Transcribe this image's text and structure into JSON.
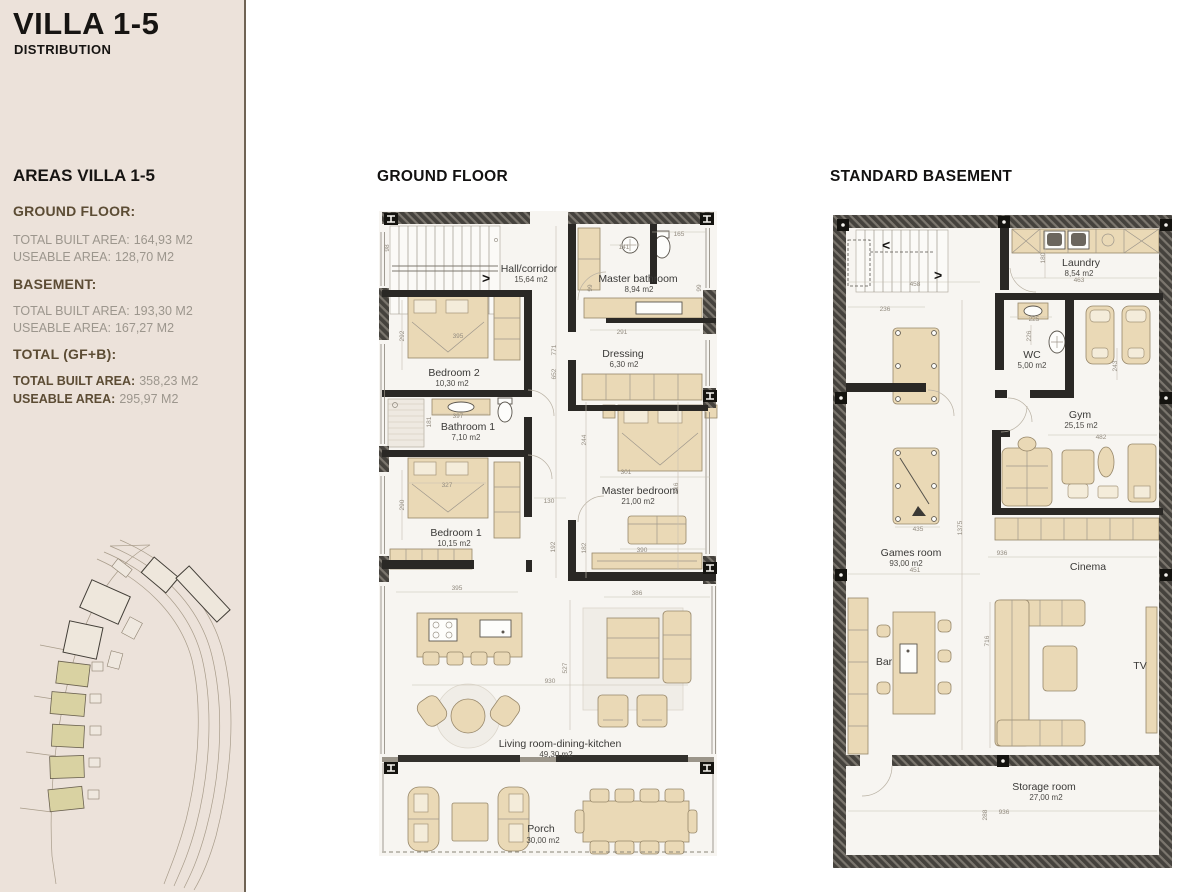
{
  "sidebar": {
    "title": "VILLA 1-5",
    "subtitle": "DISTRIBUTION",
    "areas_title": "AREAS VILLA 1-5",
    "sections": [
      {
        "heading": "GROUND FLOOR:",
        "rows": [
          {
            "label": "TOTAL BUILT AREA:",
            "value": "164,93 M2"
          },
          {
            "label": "USEABLE AREA:",
            "value": "128,70 M2"
          }
        ]
      },
      {
        "heading": "BASEMENT:",
        "rows": [
          {
            "label": "TOTAL BUILT AREA:",
            "value": "193,30 M2"
          },
          {
            "label": "USEABLE AREA:",
            "value": "167,27 M2"
          }
        ]
      },
      {
        "heading": "TOTAL (GF+B):",
        "rows": [
          {
            "label": "TOTAL BUILT AREA:",
            "value": "358,23 M2"
          },
          {
            "label": "USEABLE AREA:",
            "value": "295,97 M2"
          }
        ]
      }
    ]
  },
  "icons": {
    "stair_arrow_right": ">",
    "stair_arrow_left": "<"
  },
  "colors": {
    "sidebar_bg": "#ece2da",
    "divider": "#6f6354",
    "heading_accent": "#5c4c34",
    "muted_text": "#9c968d",
    "wall": "#45423d",
    "furniture": "#ead9b6",
    "villa_highlight": "#d9d2a2"
  },
  "ground_floor": {
    "title": "GROUND FLOOR",
    "rooms": {
      "hall": {
        "name": "Hall/corridor",
        "area": "15,64 m2"
      },
      "master_bathroom": {
        "name": "Master bathroom",
        "area": "8,94 m2"
      },
      "dressing": {
        "name": "Dressing",
        "area": "6,30 m2"
      },
      "bedroom2": {
        "name": "Bedroom 2",
        "area": "10,30 m2"
      },
      "bathroom1": {
        "name": "Bathroom 1",
        "area": "7,10 m2"
      },
      "bedroom1": {
        "name": "Bedroom 1",
        "area": "10,15 m2"
      },
      "master_bedroom": {
        "name": "Master bedroom",
        "area": "21,00 m2"
      },
      "living": {
        "name": "Living room-dining-kitchen",
        "area": "49,30 m2"
      },
      "porch": {
        "name": "Porch",
        "area": "30,00 m2"
      }
    },
    "dims": {
      "d98": "98",
      "d292": "292",
      "d395a": "395",
      "d771": "771",
      "d652": "652",
      "d141": "141",
      "d165": "165",
      "d99a": "99",
      "d99b": "99",
      "d291": "291",
      "d397": "397",
      "d181": "181",
      "d327": "327",
      "d290": "290",
      "d130": "130",
      "d244": "244",
      "d301": "301",
      "d516": "516",
      "d192": "192",
      "d182": "182",
      "d390": "390",
      "d395b": "395",
      "d386": "386",
      "d930": "930",
      "d527": "527"
    }
  },
  "basement": {
    "title": "STANDARD BASEMENT",
    "rooms": {
      "laundry": {
        "name": "Laundry",
        "area": "8,54 m2"
      },
      "wc": {
        "name": "WC",
        "area": "5,00 m2"
      },
      "gym": {
        "name": "Gym",
        "area": "25,15 m2"
      },
      "games": {
        "name": "Games room",
        "area": "93,00 m2"
      },
      "cinema": {
        "name": "Cinema",
        "area": ""
      },
      "bar": {
        "name": "Bar",
        "area": ""
      },
      "tv": {
        "name": "TV",
        "area": ""
      },
      "storage": {
        "name": "Storage room",
        "area": "27,00 m2"
      }
    },
    "dims": {
      "d458": "458",
      "d236": "236",
      "d180": "180",
      "d463": "463",
      "d225": "225",
      "d226": "226",
      "d243": "243",
      "d482": "482",
      "d435": "435",
      "d1375": "1375",
      "d936a": "936",
      "d451": "451",
      "d716": "716",
      "d288": "288",
      "d936b": "936"
    }
  }
}
